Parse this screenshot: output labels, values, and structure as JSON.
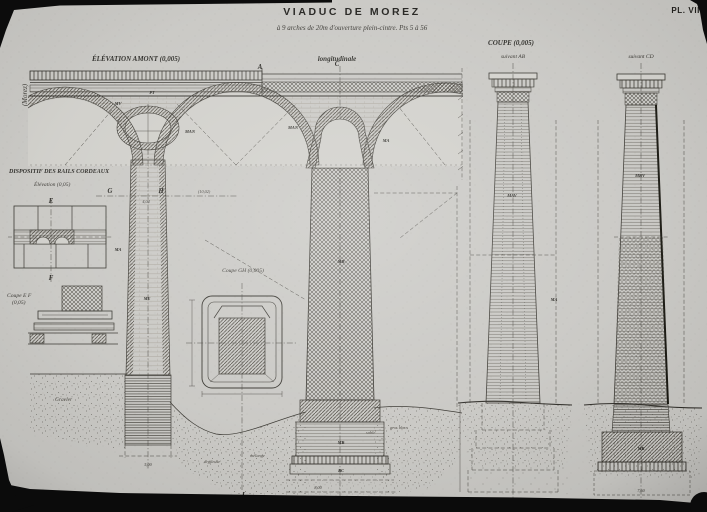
{
  "plate": {
    "title": "VIADUC DE MOREZ",
    "subtitle": "à 9 arches de 20m d'ouverture plein-cintre. Pts 5 à 56",
    "number": "PL. VII",
    "margin_note": "(Morez)"
  },
  "views": {
    "elevation": "ÉLÉVATION AMONT (0,005)",
    "longitudinal": "longitudinale",
    "coupe": "COUPE (0,005)",
    "coupe_ab": "suivant AB",
    "coupe_cd": "suivant CD",
    "rails": "DISPOSITIF DES RAILS CORDEAUX",
    "rails_elev": "Élévation (0,05)",
    "coupe_ef1": "Coupe E F",
    "coupe_ef2": "(0,05)",
    "coupe_gh": "Coupe GH (0,005)"
  },
  "letters": {
    "a": "A",
    "c": "C",
    "d": "D",
    "e": "E",
    "f": "F",
    "g": "G",
    "h": "H",
    "j": "J"
  },
  "masonry": {
    "pt": "PT",
    "mv": "MV",
    "man": "MAN",
    "me": "ME",
    "ma": "MA",
    "mb": "MB",
    "mav": "MAV",
    "mbv": "MBV",
    "bc": "BC"
  },
  "ground": {
    "gravier": "Gravier",
    "argileuse": "argileuse",
    "melange": "mélange",
    "sable": "sable",
    "gros_blocs": "gros blocs"
  },
  "dims": {
    "pier": "4,04",
    "span": "(10,02)",
    "found_left": "5,00",
    "found_center": "8,00",
    "found_cd": "7,60"
  }
}
